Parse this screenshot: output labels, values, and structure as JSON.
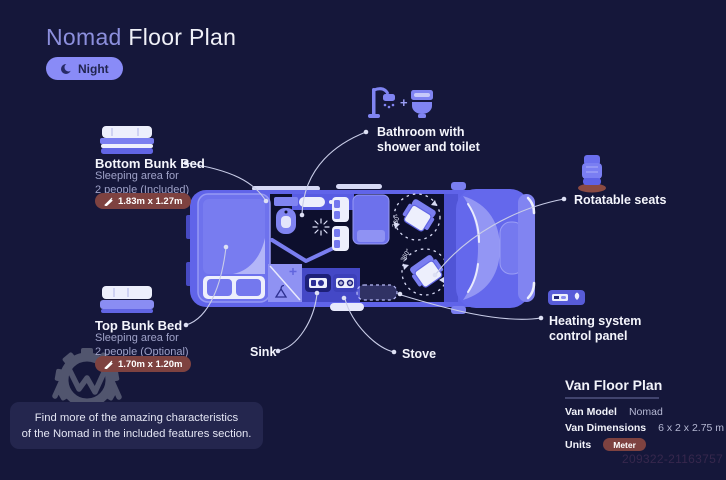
{
  "header": {
    "title_accent": "Nomad",
    "title_rest": " Floor Plan",
    "night_label": "Night"
  },
  "callouts": {
    "bottom_bunk": {
      "title": "Bottom Bunk Bed",
      "desc_line1": "Sleeping area for",
      "desc_line2": "2 people (Included)",
      "dimensions": "1.83m x 1.27m"
    },
    "top_bunk": {
      "title": "Top Bunk Bed",
      "desc_line1": "Sleeping area for",
      "desc_line2": "2 people (Optional)",
      "dimensions": "1.70m x 1.20m"
    },
    "bathroom": {
      "separator": "+",
      "line1": "Bathroom with",
      "line2": "shower and toilet"
    },
    "rotatable_seats": {
      "label": "Rotatable seats"
    },
    "heating": {
      "line1": "Heating system",
      "line2": "control panel"
    },
    "sink": {
      "label": "Sink"
    },
    "stove": {
      "label": "Stove"
    }
  },
  "floorplan": {
    "seat_rotation_front": "360°",
    "seat_rotation_rear": "360°"
  },
  "info_panel": {
    "title": "Van Floor Plan",
    "rows": [
      {
        "label": "Van Model",
        "value": "Nomad"
      },
      {
        "label": "Van Dimensions",
        "value": "6 x 2 x 2.75 m"
      },
      {
        "label": "Units",
        "value": "Meter"
      }
    ]
  },
  "note": {
    "line1": "Find more of the amazing characteristics",
    "line2": "of the Nomad in the included features section."
  },
  "watermark": {
    "id_text": "209322-21163757"
  },
  "colors": {
    "background": "#15173a",
    "accent": "#898bf7",
    "van_body": "#6064e9",
    "badge": "#7e4240",
    "muted_text": "#9fa2c8"
  }
}
